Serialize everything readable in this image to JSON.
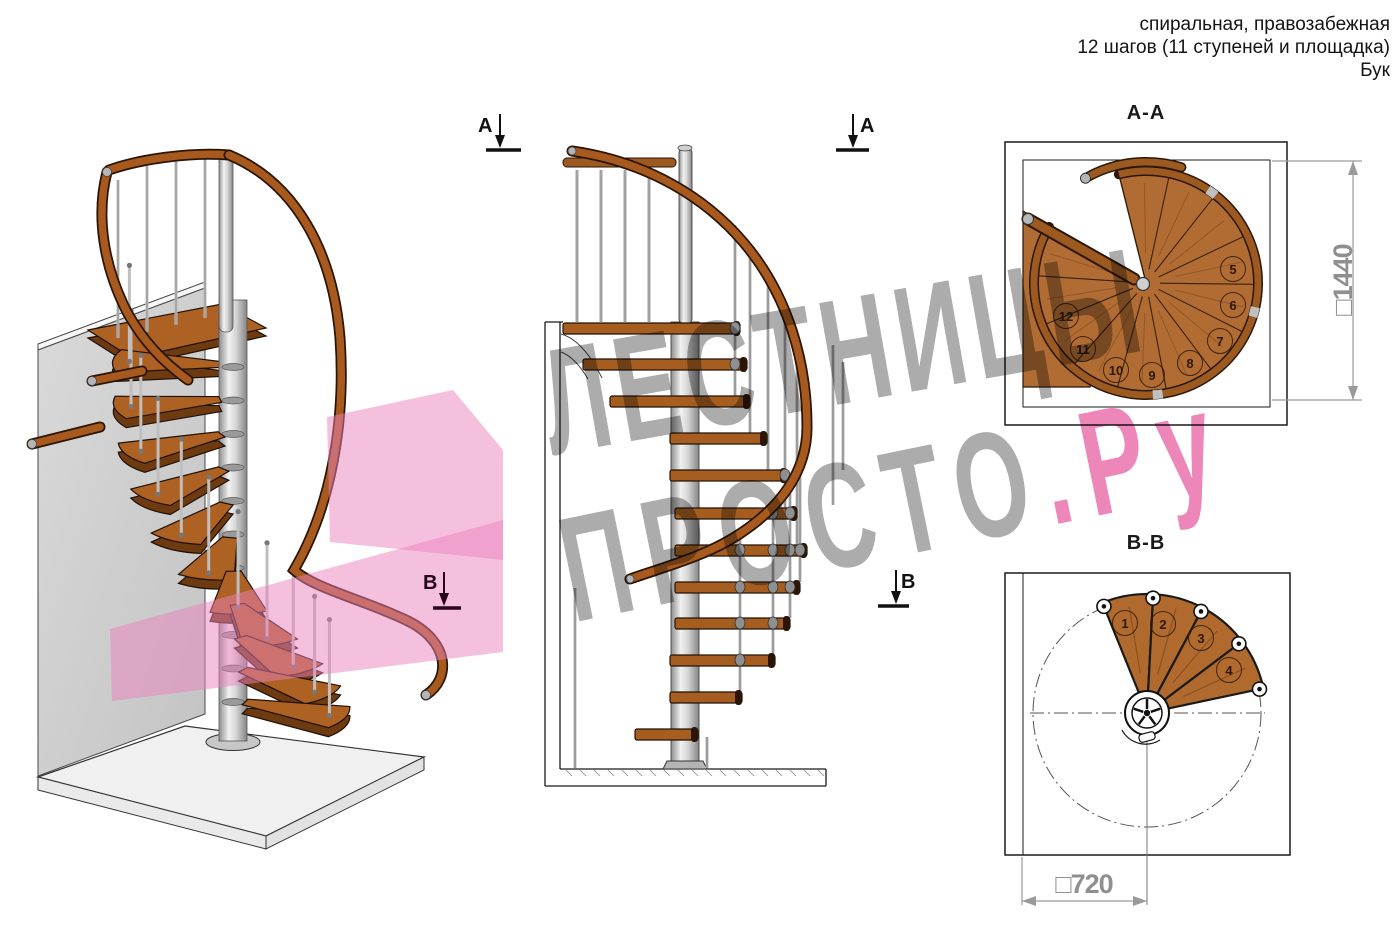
{
  "header": {
    "line1": "спиральная, правозабежная",
    "line2": "12 шагов (11 ступеней и площадка)",
    "line3": "Бук"
  },
  "views": {
    "iso": {
      "marker_b": "В"
    },
    "elevation": {
      "marker_a_left": "А",
      "marker_a_right": "А",
      "marker_b_right": "В"
    },
    "plan_aa": {
      "label": "А-А",
      "dimension": "□1440",
      "steps": [
        5,
        6,
        7,
        8,
        9,
        10,
        11,
        12
      ]
    },
    "plan_bb": {
      "label": "В-В",
      "dimension": "□720",
      "steps": [
        1,
        2,
        3,
        4
      ]
    }
  },
  "watermark": {
    "line1": "ЛЕСТНИЦЫ",
    "line2_gray": "ПРОСТО",
    "line2_pink": ".Ру"
  },
  "colors": {
    "wood": "#ad6122",
    "wood_dark": "#6e3a10",
    "wood_plan": "#b06c33",
    "rail": "#a85a1e",
    "rail_outline": "#2a1505",
    "metal_light": "#e9e9e9",
    "metal_mid": "#bfbfbf",
    "metal_dark": "#8c8c8c",
    "pink_plane": "#ec82bd",
    "dim_gray": "#9a9a9a",
    "line_black": "#1a1a1a"
  }
}
